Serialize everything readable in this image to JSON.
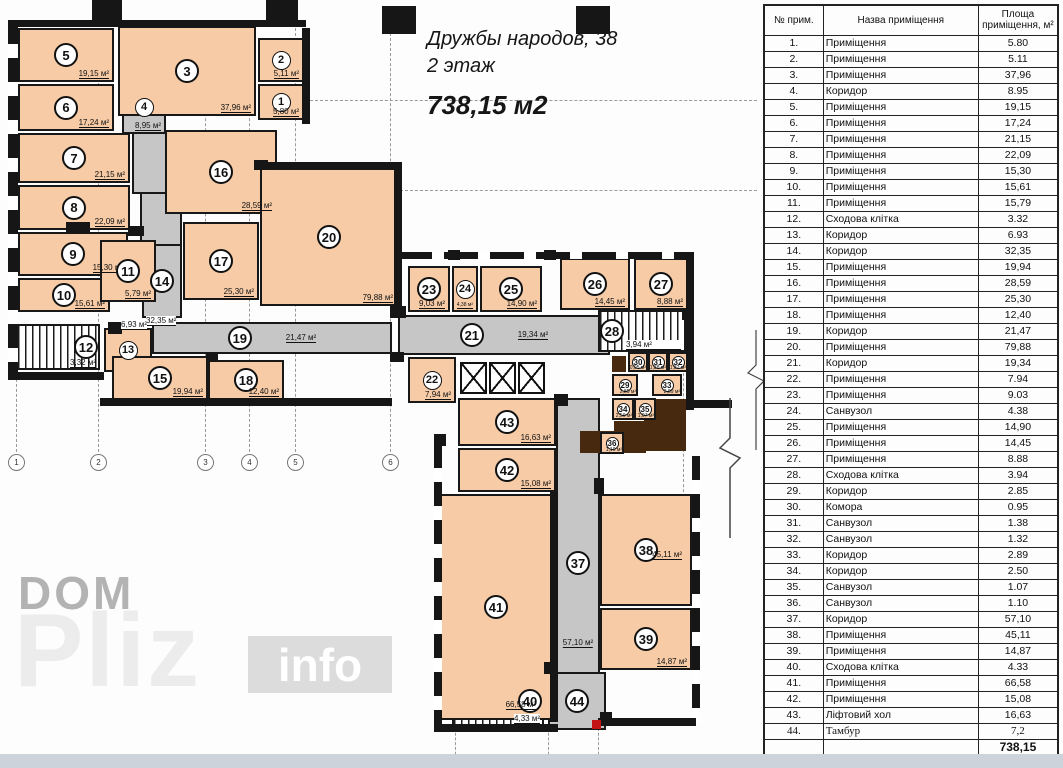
{
  "title": {
    "line1": "Дружбы народов, 38",
    "line2": "2 этаж",
    "total": "738,15 м2"
  },
  "watermark": {
    "dom": "DOM",
    "pliz": "Pliz",
    "info": "info"
  },
  "plan": {
    "grid_axes": [
      "1",
      "2",
      "3",
      "4",
      "5",
      "6"
    ],
    "rooms": [
      {
        "num": "1",
        "area": "5,80 м²"
      },
      {
        "num": "2",
        "area": "5,11 м²"
      },
      {
        "num": "3",
        "area": "37,96 м²"
      },
      {
        "num": "4",
        "area": "8,95 м²"
      },
      {
        "num": "5",
        "area": "19,15 м²"
      },
      {
        "num": "6",
        "area": "17,24 м²"
      },
      {
        "num": "7",
        "area": "21,15 м²"
      },
      {
        "num": "8",
        "area": "22,09 м²"
      },
      {
        "num": "9",
        "area": "15,30 м²"
      },
      {
        "num": "10",
        "area": "15,61 м²"
      },
      {
        "num": "11",
        "area": "5,79 м²"
      },
      {
        "num": "12",
        "area": "3,32 м²"
      },
      {
        "num": "13",
        "area": "6,93 м²"
      },
      {
        "num": "14",
        "area": "32,35 м²"
      },
      {
        "num": "15",
        "area": "19,94 м²"
      },
      {
        "num": "16",
        "area": "28,59 м²"
      },
      {
        "num": "17",
        "area": "25,30 м²"
      },
      {
        "num": "18",
        "area": "12,40 м²"
      },
      {
        "num": "19",
        "area": "21,47 м²"
      },
      {
        "num": "20",
        "area": "79,88 м²"
      },
      {
        "num": "21",
        "area": "19,34 м²"
      },
      {
        "num": "22",
        "area": "7,94 м²"
      },
      {
        "num": "23",
        "area": "9,03 м²"
      },
      {
        "num": "24",
        "area": "4,38 м²"
      },
      {
        "num": "25",
        "area": "14,90 м²"
      },
      {
        "num": "26",
        "area": "14,45 м²"
      },
      {
        "num": "27",
        "area": "8,88 м²"
      },
      {
        "num": "28",
        "area": "3,94 м²"
      },
      {
        "num": "29",
        "area": "2,85 м²"
      },
      {
        "num": "30",
        "area": "0,95 м²"
      },
      {
        "num": "31",
        "area": "1,38 м²"
      },
      {
        "num": "32",
        "area": "1,32 м²"
      },
      {
        "num": "33",
        "area": "2,89 м²"
      },
      {
        "num": "34",
        "area": "2,50 м²"
      },
      {
        "num": "35",
        "area": "1,07 м²"
      },
      {
        "num": "36",
        "area": "1,10 м²"
      },
      {
        "num": "37",
        "area": "57,10 м²"
      },
      {
        "num": "38",
        "area": "45,11 м²"
      },
      {
        "num": "39",
        "area": "14,87 м²"
      },
      {
        "num": "40",
        "area": "4,33 м²"
      },
      {
        "num": "41",
        "area": "66,58 м²"
      },
      {
        "num": "42",
        "area": "15,08 м²"
      },
      {
        "num": "43",
        "area": "16,63 м²"
      },
      {
        "num": "44",
        "area": ""
      }
    ]
  },
  "table": {
    "headers": {
      "num": "№ прим.",
      "name": "Назва приміщення",
      "area": "Площа приміщення, м²"
    },
    "rows": [
      {
        "num": "1.",
        "name": "Приміщення",
        "area": "5.80"
      },
      {
        "num": "2.",
        "name": "Приміщення",
        "area": "5.11"
      },
      {
        "num": "3.",
        "name": "Приміщення",
        "area": "37,96"
      },
      {
        "num": "4.",
        "name": "Коридор",
        "area": "8.95"
      },
      {
        "num": "5.",
        "name": "Приміщення",
        "area": "19,15"
      },
      {
        "num": "6.",
        "name": "Приміщення",
        "area": "17,24"
      },
      {
        "num": "7.",
        "name": "Приміщення",
        "area": "21,15"
      },
      {
        "num": "8.",
        "name": "Приміщення",
        "area": "22,09"
      },
      {
        "num": "9.",
        "name": "Приміщення",
        "area": "15,30"
      },
      {
        "num": "10.",
        "name": "Приміщення",
        "area": "15,61"
      },
      {
        "num": "11.",
        "name": "Приміщення",
        "area": "15,79"
      },
      {
        "num": "12.",
        "name": "Сходова клітка",
        "area": "3.32"
      },
      {
        "num": "13.",
        "name": "Коридор",
        "area": "6.93"
      },
      {
        "num": "14.",
        "name": "Коридор",
        "area": "32,35"
      },
      {
        "num": "15.",
        "name": "Приміщення",
        "area": "19,94"
      },
      {
        "num": "16.",
        "name": "Приміщення",
        "area": "28,59"
      },
      {
        "num": "17.",
        "name": "Приміщення",
        "area": "25,30"
      },
      {
        "num": "18.",
        "name": "Приміщення",
        "area": "12,40"
      },
      {
        "num": "19.",
        "name": "Коридор",
        "area": "21,47"
      },
      {
        "num": "20.",
        "name": "Приміщення",
        "area": "79,88"
      },
      {
        "num": "21.",
        "name": "Коридор",
        "area": "19,34"
      },
      {
        "num": "22.",
        "name": "Приміщення",
        "area": "7.94"
      },
      {
        "num": "23.",
        "name": "Приміщення",
        "area": "9.03"
      },
      {
        "num": "24.",
        "name": "Санвузол",
        "area": "4.38"
      },
      {
        "num": "25.",
        "name": "Приміщення",
        "area": "14,90"
      },
      {
        "num": "26.",
        "name": "Приміщення",
        "area": "14,45"
      },
      {
        "num": "27.",
        "name": "Приміщення",
        "area": "8.88"
      },
      {
        "num": "28.",
        "name": "Сходова клітка",
        "area": "3.94"
      },
      {
        "num": "29.",
        "name": "Коридор",
        "area": "2.85"
      },
      {
        "num": "30.",
        "name": "Комора",
        "area": "0.95"
      },
      {
        "num": "31.",
        "name": "Санвузол",
        "area": "1.38"
      },
      {
        "num": "32.",
        "name": "Санвузол",
        "area": "1.32"
      },
      {
        "num": "33.",
        "name": "Коридор",
        "area": "2.89"
      },
      {
        "num": "34.",
        "name": "Коридор",
        "area": "2.50"
      },
      {
        "num": "35.",
        "name": "Санвузол",
        "area": "1.07"
      },
      {
        "num": "36.",
        "name": "Санвузол",
        "area": "1.10"
      },
      {
        "num": "37.",
        "name": "Коридор",
        "area": "57,10"
      },
      {
        "num": "38.",
        "name": "Приміщення",
        "area": "45,11"
      },
      {
        "num": "39.",
        "name": "Приміщення",
        "area": "14,87"
      },
      {
        "num": "40.",
        "name": "Сходова клітка",
        "area": "4.33"
      },
      {
        "num": "41.",
        "name": "Приміщення",
        "area": "66,58"
      },
      {
        "num": "42.",
        "name": "Приміщення",
        "area": "15,08"
      },
      {
        "num": "43.",
        "name": "Ліфтовий хол",
        "area": "16,63"
      },
      {
        "num": "44.",
        "name": "Тамбур",
        "area": "7,2",
        "variant": "serif"
      }
    ],
    "total": "738,15"
  },
  "colors": {
    "room_fill": "#f6cba6",
    "corridor_fill": "#c6c6c6",
    "wall": "#161616",
    "accent_brown": "#46290f",
    "red_mark": "#c21414"
  }
}
